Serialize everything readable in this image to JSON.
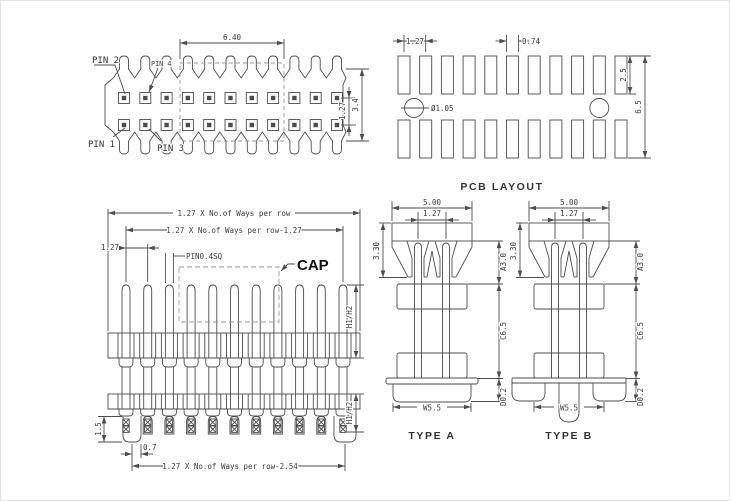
{
  "colors": {
    "line": "#4d4d4d",
    "text": "#3d3d3d",
    "dash": "#9a9a9a",
    "background": "#ffffff"
  },
  "structure": {
    "top_view": {
      "pins_per_row": 11,
      "rows": 2
    },
    "pcb_layout": {
      "pads_per_row": 11,
      "rows": 2
    },
    "front_view": {
      "pins_per_row": 11
    }
  },
  "top_view": {
    "pin1": "PIN 1",
    "pin2": "PIN 2",
    "pin3": "PIN 3",
    "pin4": "PIN 4",
    "dim_cap_width": "6.40",
    "dim_row_pitch": "1.27",
    "dim_body_width": "3.4"
  },
  "pcb_layout": {
    "title": "PCB LAYOUT",
    "dim_pitch": "1.27",
    "dim_pad_width": "0.74",
    "dim_pad_height": "2.5",
    "dim_span": "6.5",
    "dim_hole": "Ø1.05"
  },
  "front_view": {
    "cap_label": "CAP",
    "dim_total": "1.27 X No.of Ways per row",
    "dim_span": "1.27 X No.of Ways per row-1.27",
    "dim_pitch": "1.27",
    "dim_pin": "PIN0.4SQ",
    "dim_h_upper": "H1/H2",
    "dim_h_lower": "H1/H2",
    "dim_peg": "1.5",
    "dim_offset": "0.7",
    "dim_bottom": "1.27 X No.of Ways per row-2.54"
  },
  "type_a": {
    "title": "TYPE A",
    "dim_width": "5.00",
    "dim_pitch": "1.27",
    "dim_cap_height": "3.30",
    "dim_a": "A3.0",
    "dim_c": "C6.5",
    "dim_d": "D0.2",
    "dim_w": "W5.5"
  },
  "type_b": {
    "title": "TYPE B",
    "dim_width": "5.00",
    "dim_pitch": "1.27",
    "dim_cap_height": "3.30",
    "dim_a": "A3.0",
    "dim_c": "C6.5",
    "dim_d": "D0.2",
    "dim_w": "W5.5"
  }
}
